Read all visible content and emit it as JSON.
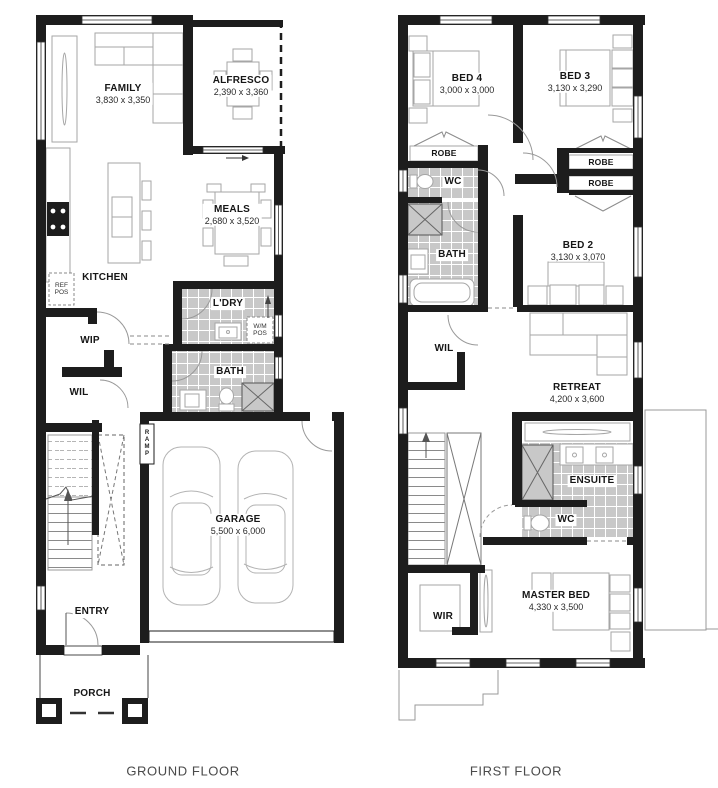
{
  "captions": {
    "ground": "GROUND FLOOR",
    "first": "FIRST FLOOR"
  },
  "ground": {
    "family": {
      "name": "FAMILY",
      "dims": "3,830 x 3,350"
    },
    "alfresco": {
      "name": "ALFRESCO",
      "dims": "2,390 x 3,360"
    },
    "meals": {
      "name": "MEALS",
      "dims": "2,680 x 3,520"
    },
    "kitchen": {
      "name": "KITCHEN"
    },
    "ref_pos": {
      "name": "REF\nPOS"
    },
    "wip": {
      "name": "WIP"
    },
    "ldry": {
      "name": "L'DRY"
    },
    "wm_pos": {
      "name": "W/M\nPOS"
    },
    "bath": {
      "name": "BATH"
    },
    "wil": {
      "name": "WIL"
    },
    "ramp": {
      "name": "RAMP"
    },
    "garage": {
      "name": "GARAGE",
      "dims": "5,500 x 6,000"
    },
    "entry": {
      "name": "ENTRY"
    },
    "porch": {
      "name": "PORCH"
    }
  },
  "first": {
    "bed4": {
      "name": "BED 4",
      "dims": "3,000 x 3,000"
    },
    "bed3": {
      "name": "BED 3",
      "dims": "3,130 x 3,290"
    },
    "robe_bed4": {
      "name": "ROBE"
    },
    "wc_upper": {
      "name": "WC"
    },
    "bath": {
      "name": "BATH"
    },
    "robe_a": {
      "name": "ROBE"
    },
    "robe_b": {
      "name": "ROBE"
    },
    "bed2": {
      "name": "BED 2",
      "dims": "3,130 x 3,070"
    },
    "wil": {
      "name": "WIL"
    },
    "retreat": {
      "name": "RETREAT",
      "dims": "4,200 x 3,600"
    },
    "ensuite": {
      "name": "ENSUITE"
    },
    "wc_lower": {
      "name": "WC"
    },
    "wir": {
      "name": "WIR"
    },
    "master": {
      "name": "MASTER BED",
      "dims": "4,330 x 3,500"
    }
  },
  "colors": {
    "wall": "#1d1d1d",
    "tile": "#c8c8c8",
    "furniture": "#a6a6a6"
  }
}
